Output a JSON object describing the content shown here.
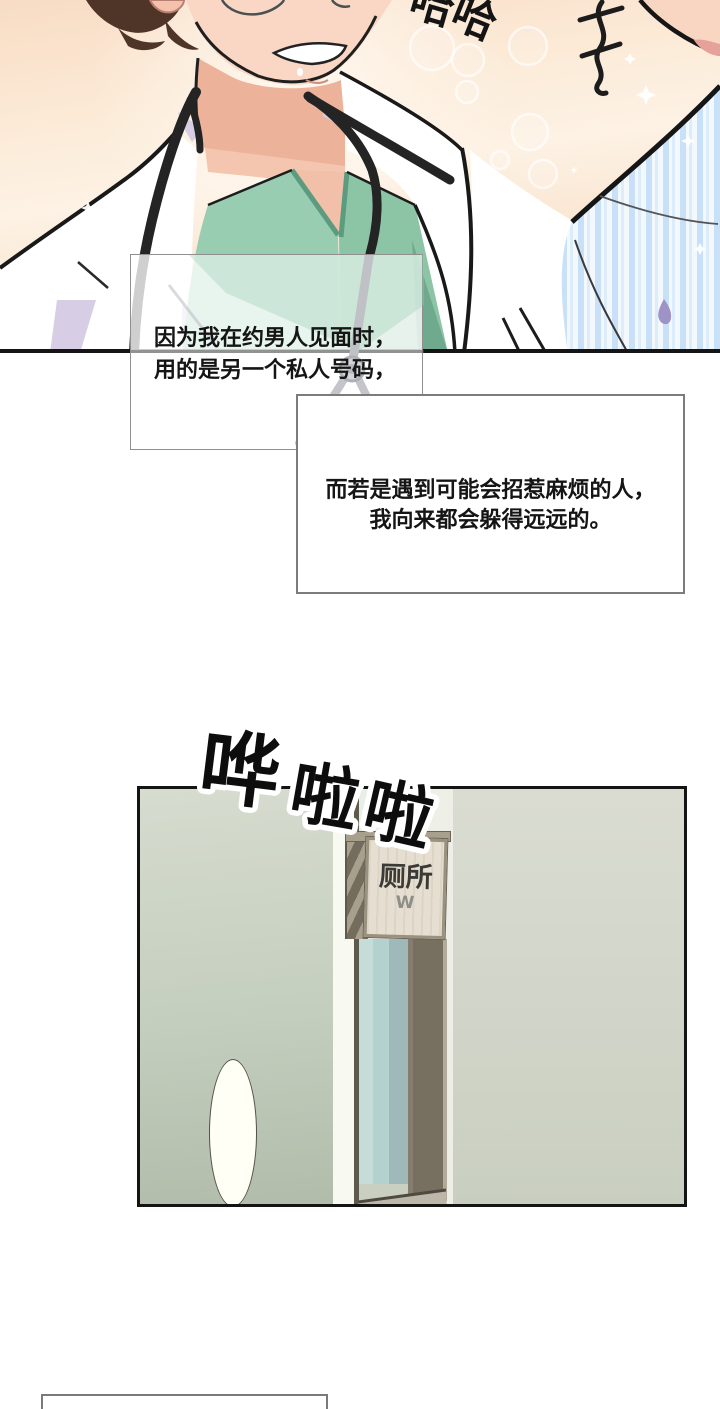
{
  "page": {
    "width": 720,
    "height": 1409,
    "background": "#ffffff",
    "kind": "manhwa comic page"
  },
  "panel1": {
    "description": "doctor with stethoscope laughing, second person in striped shirt at right",
    "laugh_sfx": {
      "full": "哈哈",
      "chars": [
        "哈",
        "哈"
      ]
    },
    "colors": {
      "bg_peach": "#f9e1ca",
      "skin": "#f8d6c3",
      "skin_shadow": "#edb199",
      "hair_brown": "#4e3528",
      "coat_white": "#ffffff",
      "coat_shadow_lavender": "#d7cde4",
      "scrub_green": "#98cdb1",
      "scrub_green_dark": "#5b9c80",
      "stethoscope_black": "#242424",
      "shirt_stripe_blue": "#c9e1f8",
      "sweat_drop_purple": "#9e92c6"
    }
  },
  "narration_boxes": [
    {
      "lines": [
        "因为我在约男人见面时，",
        "用的是另一个私人号码，"
      ],
      "align": "left"
    },
    {
      "lines": [
        "而若是遇到可能会招惹麻烦的人，",
        "我向来都会躲得远远的。"
      ],
      "align": "center"
    },
    {
      "lines": [],
      "note": "empty box partially visible at page bottom"
    }
  ],
  "sfx": {
    "text": "哗啦啦",
    "chars": [
      "哗",
      "啦",
      "啦"
    ],
    "style": "large black glyphs with white outline, tilted, descending to the right"
  },
  "panel2": {
    "description": "corridor view of toilet door with glass panel",
    "sign": {
      "title": "厕所",
      "letter": "W"
    },
    "colors": {
      "wall_left_sage": "#c4cebe",
      "wall_right_gray": "#d1d5c9",
      "door_glass": "#b2d1cf",
      "door_glass_shade": "#9fb8b9",
      "frame_dark": "#5f5a4e",
      "frame_tan": "#a89f8d",
      "sign_face": "#e6dfd1",
      "highlight_white": "#f8faf1"
    }
  }
}
